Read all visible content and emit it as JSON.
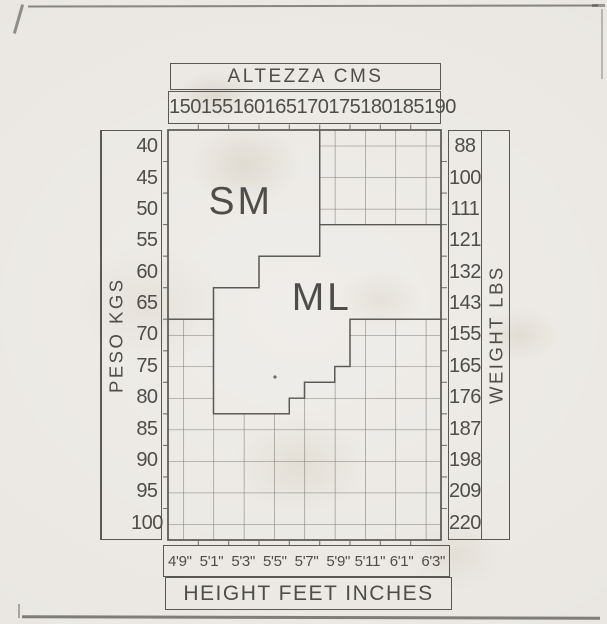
{
  "theme": {
    "paper": "#eae7e2",
    "ink": "#4f4d49",
    "line": "#5a5853",
    "hatch": "#7e7c76"
  },
  "chart_data": {
    "type": "heatmap",
    "title": "Hosiery size chart: SM / ML coverage by height and weight",
    "x_top": {
      "label": "ALTEZZA CMS",
      "ticks": [
        "150",
        "155",
        "160",
        "165",
        "170",
        "175",
        "180",
        "185",
        "190"
      ]
    },
    "x_bottom": {
      "label": "HEIGHT FEET INCHES",
      "ticks": [
        "4'9\"",
        "5'1\"",
        "5'3\"",
        "5'5\"",
        "5'7\"",
        "5'9\"",
        "5'11\"",
        "6'1\"",
        "6'3\""
      ]
    },
    "y_left": {
      "label": "PESO KGS",
      "ticks": [
        "40",
        "45",
        "50",
        "55",
        "60",
        "65",
        "70",
        "75",
        "80",
        "85",
        "90",
        "95",
        "100"
      ]
    },
    "y_right": {
      "label": "WEIGHT LBS",
      "ticks": [
        "88",
        "100",
        "111",
        "121",
        "132",
        "143",
        "155",
        "165",
        "176",
        "187",
        "198",
        "209",
        "220"
      ]
    },
    "grid": {
      "columns": 9,
      "rows": 13
    },
    "regions": [
      {
        "name": "SM",
        "label_pos": [
          2.4,
          2.22
        ],
        "polygon": [
          [
            0,
            0
          ],
          [
            5,
            0
          ],
          [
            5,
            4
          ],
          [
            3,
            4
          ],
          [
            3,
            5
          ],
          [
            1.5,
            5
          ],
          [
            1.5,
            6
          ],
          [
            0,
            6
          ]
        ]
      },
      {
        "name": "ML",
        "label_pos": [
          5.07,
          5.26
        ],
        "polygon": [
          [
            5,
            3
          ],
          [
            9,
            3
          ],
          [
            9,
            6
          ],
          [
            6,
            6
          ],
          [
            6,
            7.5
          ],
          [
            5.5,
            7.5
          ],
          [
            5.5,
            8
          ],
          [
            4.5,
            8
          ],
          [
            4.5,
            8.5
          ],
          [
            4,
            8.5
          ],
          [
            4,
            9
          ],
          [
            1.5,
            9
          ],
          [
            1.5,
            5
          ],
          [
            3,
            5
          ],
          [
            3,
            4
          ],
          [
            5,
            4
          ]
        ]
      }
    ],
    "blank_hatched_polygons": [
      [
        [
          5,
          0
        ],
        [
          9,
          0
        ],
        [
          9,
          3
        ],
        [
          5,
          3
        ]
      ],
      [
        [
          0,
          6
        ],
        [
          1.5,
          6
        ],
        [
          1.5,
          9
        ],
        [
          4,
          9
        ],
        [
          4,
          8.5
        ],
        [
          4.5,
          8.5
        ],
        [
          4.5,
          8
        ],
        [
          5.5,
          8
        ],
        [
          5.5,
          7.5
        ],
        [
          6,
          7.5
        ],
        [
          6,
          6
        ],
        [
          9,
          6
        ],
        [
          9,
          13
        ],
        [
          0,
          13
        ]
      ]
    ]
  }
}
